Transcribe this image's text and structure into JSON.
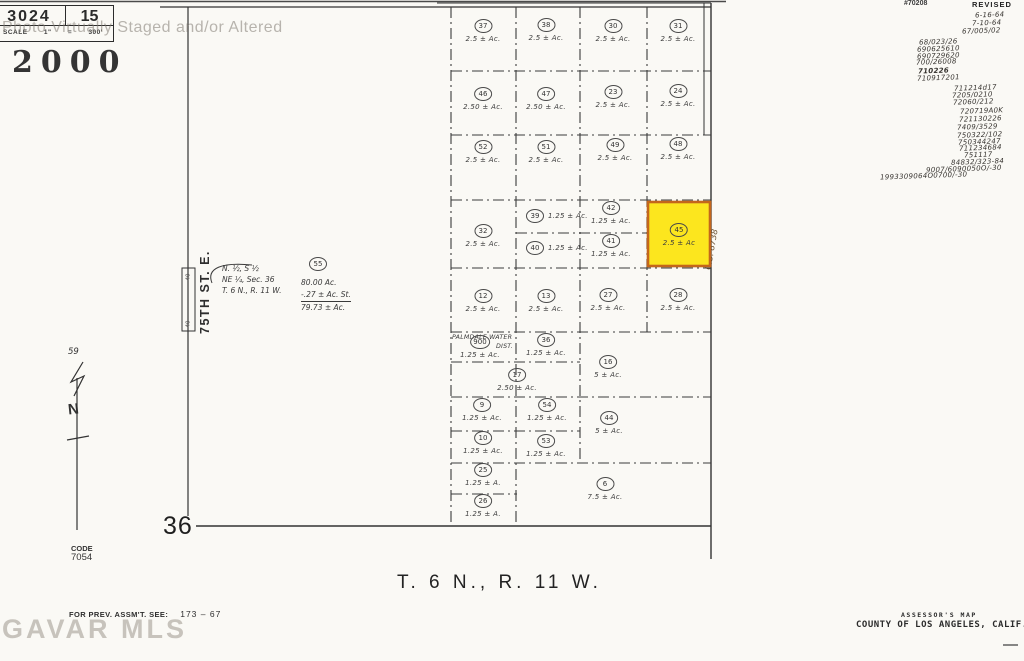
{
  "page": {
    "watermark_top": "Photo Virtually Staged and/or Altered",
    "watermark_bottom": "GAVAR MLS",
    "year_stamp": "2000"
  },
  "header_box": {
    "book": "3024",
    "page": "15",
    "scale": "SCALE 1\" = 300'"
  },
  "revisions": {
    "sheet_note": "#70208",
    "label": "REVISED",
    "items": [
      {
        "text": "6-16-64",
        "x": 975,
        "y": 11
      },
      {
        "text": "7-10-64",
        "x": 972,
        "y": 19
      },
      {
        "text": "67/005/02",
        "x": 962,
        "y": 27
      },
      {
        "text": "68/023/26",
        "x": 919,
        "y": 38
      },
      {
        "text": "690625610",
        "x": 917,
        "y": 45
      },
      {
        "text": "690729620",
        "x": 917,
        "y": 52
      },
      {
        "text": "700/26008",
        "x": 916,
        "y": 58
      },
      {
        "text": "710226",
        "x": 918,
        "y": 67,
        "b": true
      },
      {
        "text": "710917201",
        "x": 917,
        "y": 74
      },
      {
        "text": "711214d17",
        "x": 954,
        "y": 84
      },
      {
        "text": "7205/0210",
        "x": 952,
        "y": 91
      },
      {
        "text": "72060/212",
        "x": 953,
        "y": 98
      },
      {
        "text": "720719A0K",
        "x": 960,
        "y": 107
      },
      {
        "text": "721130226",
        "x": 959,
        "y": 115
      },
      {
        "text": "7409/3529",
        "x": 957,
        "y": 123
      },
      {
        "text": "750322/102",
        "x": 957,
        "y": 131
      },
      {
        "text": "750344247",
        "x": 958,
        "y": 138
      },
      {
        "text": "711234684",
        "x": 959,
        "y": 144
      },
      {
        "text": "751117",
        "x": 964,
        "y": 151
      },
      {
        "text": "84832/323-84",
        "x": 951,
        "y": 158
      },
      {
        "text": "9007/6090050O/-30",
        "x": 926,
        "y": 165
      },
      {
        "text": "1993309064O0700/-30",
        "x": 880,
        "y": 172
      }
    ]
  },
  "map": {
    "street_label": "75TH ST. E.",
    "street_width_label": "40",
    "north_label": "N",
    "north_number": "59",
    "section_number": "36",
    "township_label": "T. 6 N., R. 11 W.",
    "cs_label": "C.S. 8738",
    "note_lines": [
      "N. ½, S ½",
      "NE ¼, Sec. 36",
      "T. 6 N., R. 11 W."
    ],
    "water_district_line1": "PALMDALE WATER",
    "water_district_line2": "DIST.",
    "big_parcel": {
      "num": "55",
      "area_total": "80.00 Ac.",
      "area_less": "-.27 ± Ac. St.",
      "area_net": "79.73 ± Ac."
    },
    "highlighted_parcel": {
      "num": "45",
      "fill": "#fce61e",
      "stroke": "#c4661b"
    },
    "parcels": [
      {
        "num": "37",
        "area": "2.5 ± Ac.",
        "x": 483,
        "y": 31
      },
      {
        "num": "38",
        "area": "2.5 ± Ac.",
        "x": 546,
        "y": 30
      },
      {
        "num": "30",
        "area": "2.5 ± Ac.",
        "x": 613,
        "y": 31
      },
      {
        "num": "31",
        "area": "2.5 ± Ac.",
        "x": 678,
        "y": 31
      },
      {
        "num": "46",
        "area": "2.50 ± Ac.",
        "x": 483,
        "y": 99
      },
      {
        "num": "47",
        "area": "2.50 ± Ac.",
        "x": 546,
        "y": 99
      },
      {
        "num": "23",
        "area": "2.5 ± Ac.",
        "x": 613,
        "y": 97
      },
      {
        "num": "24",
        "area": "2.5 ± Ac.",
        "x": 678,
        "y": 96
      },
      {
        "num": "52",
        "area": "2.5 ± Ac.",
        "x": 483,
        "y": 152
      },
      {
        "num": "51",
        "area": "2.5 ± Ac.",
        "x": 546,
        "y": 152
      },
      {
        "num": "49",
        "area": "2.5 ± Ac.",
        "x": 615,
        "y": 150
      },
      {
        "num": "48",
        "area": "2.5 ± Ac.",
        "x": 678,
        "y": 149
      },
      {
        "num": "32",
        "area": "2.5 ± Ac.",
        "x": 483,
        "y": 236
      },
      {
        "num": "39",
        "area": "1.25 ± Ac.",
        "x": 536,
        "y": 216,
        "side": "r"
      },
      {
        "num": "40",
        "area": "1.25 ± Ac.",
        "x": 536,
        "y": 248,
        "side": "r"
      },
      {
        "num": "42",
        "area": "1.25 ± Ac.",
        "x": 611,
        "y": 213
      },
      {
        "num": "41",
        "area": "1.25 ± Ac.",
        "x": 611,
        "y": 246
      },
      {
        "num": "45",
        "area": "2.5 ± Ac",
        "x": 679,
        "y": 235
      },
      {
        "num": "12",
        "area": "2.5 ± Ac.",
        "x": 483,
        "y": 301
      },
      {
        "num": "13",
        "area": "2.5 ± Ac.",
        "x": 546,
        "y": 301
      },
      {
        "num": "27",
        "area": "2.5 ± Ac.",
        "x": 608,
        "y": 300
      },
      {
        "num": "28",
        "area": "2.5 ± Ac.",
        "x": 678,
        "y": 300
      },
      {
        "num": "900",
        "area": "1.25 ± Ac.",
        "x": 480,
        "y": 347
      },
      {
        "num": "36",
        "area": "1.25 ± Ac.",
        "x": 546,
        "y": 345
      },
      {
        "num": "16",
        "area": "5 ± Ac.",
        "x": 608,
        "y": 367
      },
      {
        "num": "17",
        "area": "2.50 ± Ac.",
        "x": 517,
        "y": 380
      },
      {
        "num": "9",
        "area": "1.25 ± Ac.",
        "x": 482,
        "y": 410
      },
      {
        "num": "54",
        "area": "1.25 ± Ac.",
        "x": 547,
        "y": 410
      },
      {
        "num": "10",
        "area": "1.25 ± Ac.",
        "x": 483,
        "y": 443
      },
      {
        "num": "53",
        "area": "1.25 ± Ac.",
        "x": 546,
        "y": 446
      },
      {
        "num": "44",
        "area": "5 ± Ac.",
        "x": 609,
        "y": 423
      },
      {
        "num": "25",
        "area": "1.25 ± A.",
        "x": 483,
        "y": 475
      },
      {
        "num": "26",
        "area": "1.25 ± A.",
        "x": 483,
        "y": 506
      },
      {
        "num": "6",
        "area": "7.5 ± Ac.",
        "x": 605,
        "y": 489
      },
      {
        "num": "55",
        "area": "",
        "x": 318,
        "y": 264
      }
    ]
  },
  "footer": {
    "code_label": "CODE",
    "code_value": "7054",
    "prev_label": "FOR PREV. ASSM'T. SEE:",
    "prev_value": "173 – 67",
    "assessors_map": "ASSESSOR'S MAP",
    "county": "COUNTY OF LOS ANGELES, CALIF."
  }
}
